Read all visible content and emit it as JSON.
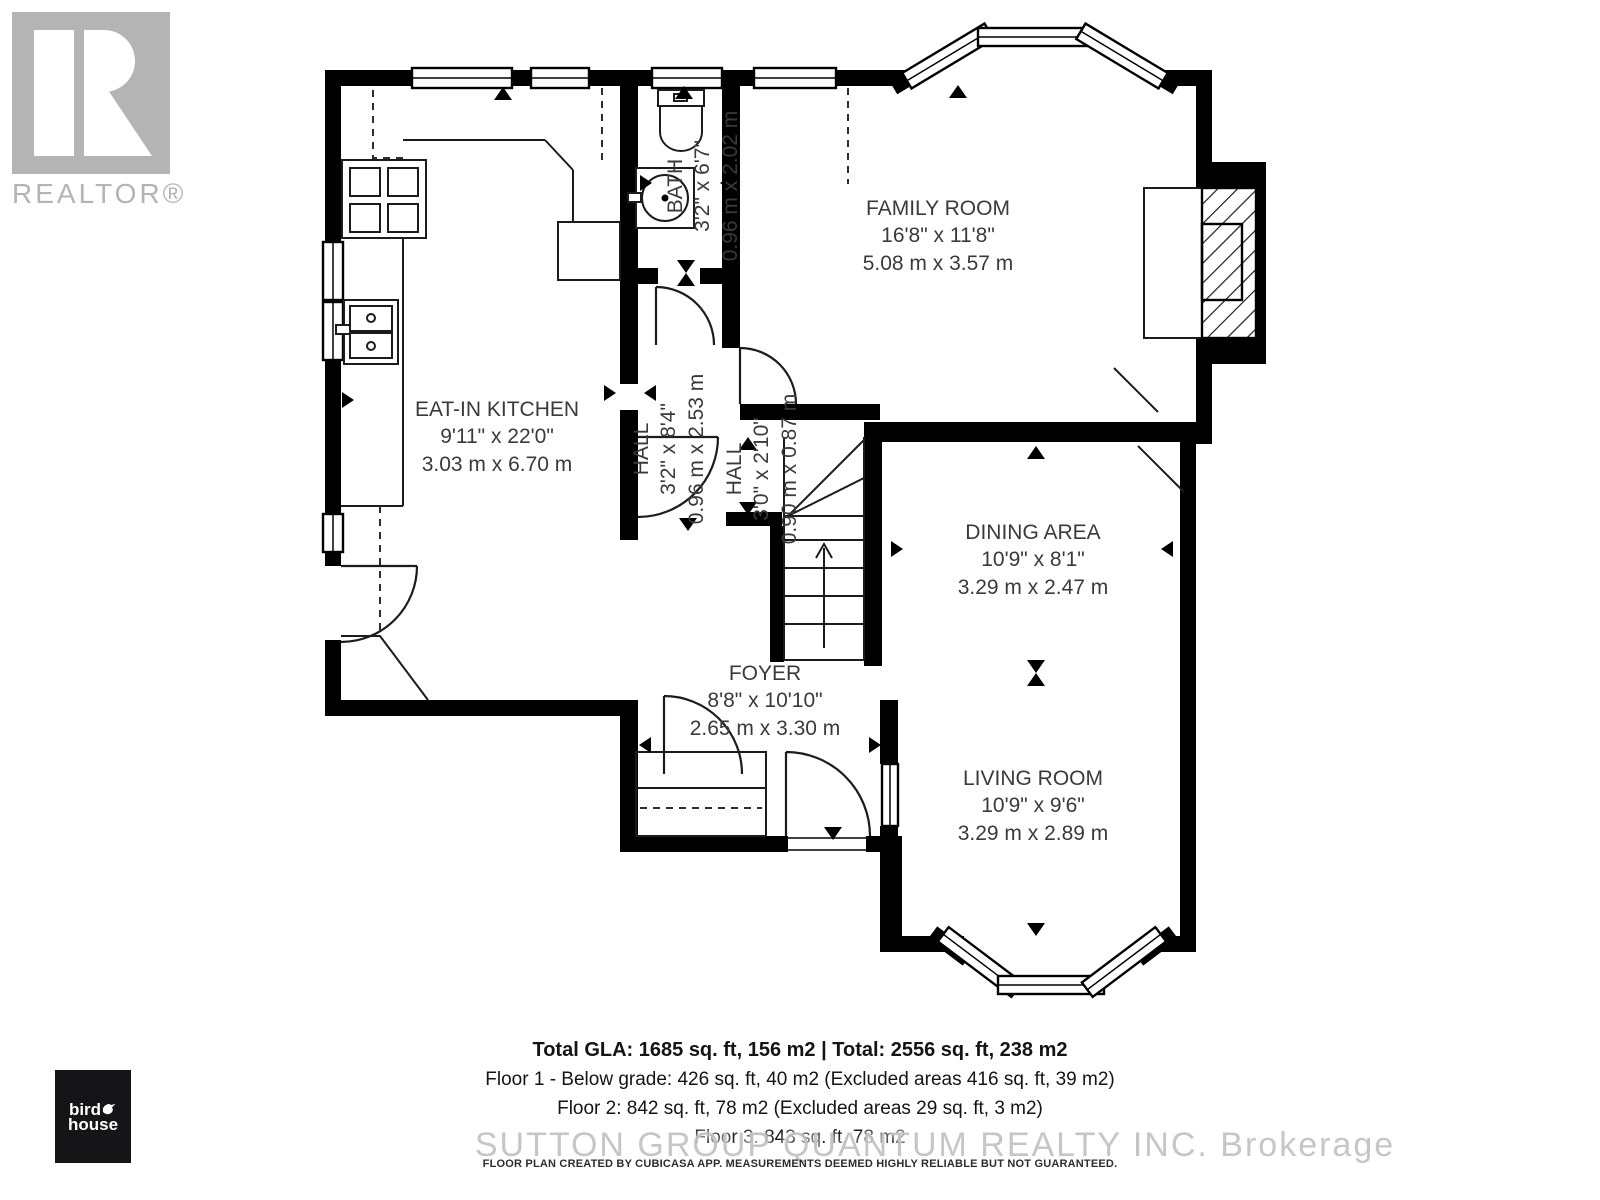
{
  "branding": {
    "realtor_logo_text": "REALTOR®",
    "birdhouse_word1": "bird",
    "birdhouse_word2": "house"
  },
  "rooms": {
    "family_room": {
      "name": "FAMILY ROOM",
      "size_imperial": "16'8\" x 11'8\"",
      "size_metric": "5.08 m x 3.57 m"
    },
    "kitchen": {
      "name": "EAT-IN KITCHEN",
      "size_imperial": "9'11\" x 22'0\"",
      "size_metric": "3.03 m x 6.70 m"
    },
    "bath": {
      "name": "BATH",
      "size_imperial": "3'2\" x 6'7\"",
      "size_metric": "0.96 m x 2.02 m"
    },
    "hall": {
      "name": "HALL",
      "size_imperial": "3'2\" x 8'4\"",
      "size_metric": "0.96 m x 2.53 m"
    },
    "hall_small": {
      "name": "HALL",
      "size_imperial": "3'0\" x 2'10\"",
      "size_metric": "0.90 m x 0.87 m"
    },
    "dining": {
      "name": "DINING AREA",
      "size_imperial": "10'9\" x 8'1\"",
      "size_metric": "3.29 m x 2.47 m"
    },
    "foyer": {
      "name": "FOYER",
      "size_imperial": "8'8\" x 10'10\"",
      "size_metric": "2.65 m x 3.30 m"
    },
    "living": {
      "name": "LIVING ROOM",
      "size_imperial": "10'9\" x 9'6\"",
      "size_metric": "3.29 m x 2.89 m"
    }
  },
  "summary": {
    "total_line": "Total GLA: 1685 sq. ft, 156 m2 | Total: 2556 sq. ft, 238 m2",
    "floor1_line": "Floor 1 - Below grade: 426 sq. ft, 40 m2 (Excluded areas 416 sq. ft, 39 m2)",
    "floor2_line": "Floor 2: 842 sq. ft, 78 m2 (Excluded areas 29 sq. ft, 3 m2)",
    "floor3_line": "Floor 3: 843 sq. ft, 78 m2"
  },
  "watermark": "SUTTON GROUP QUANTUM REALTY INC.  Brokerage",
  "disclaimer": "FLOOR PLAN CREATED BY CUBICASA APP. MEASUREMENTS DEEMED HIGHLY RELIABLE BUT NOT GUARANTEED.",
  "colors": {
    "wall": "#000000",
    "label_text": "#3a3a3a",
    "logo_gray": "#b4b4b4",
    "watermark_gray": "#c3c3c3"
  }
}
